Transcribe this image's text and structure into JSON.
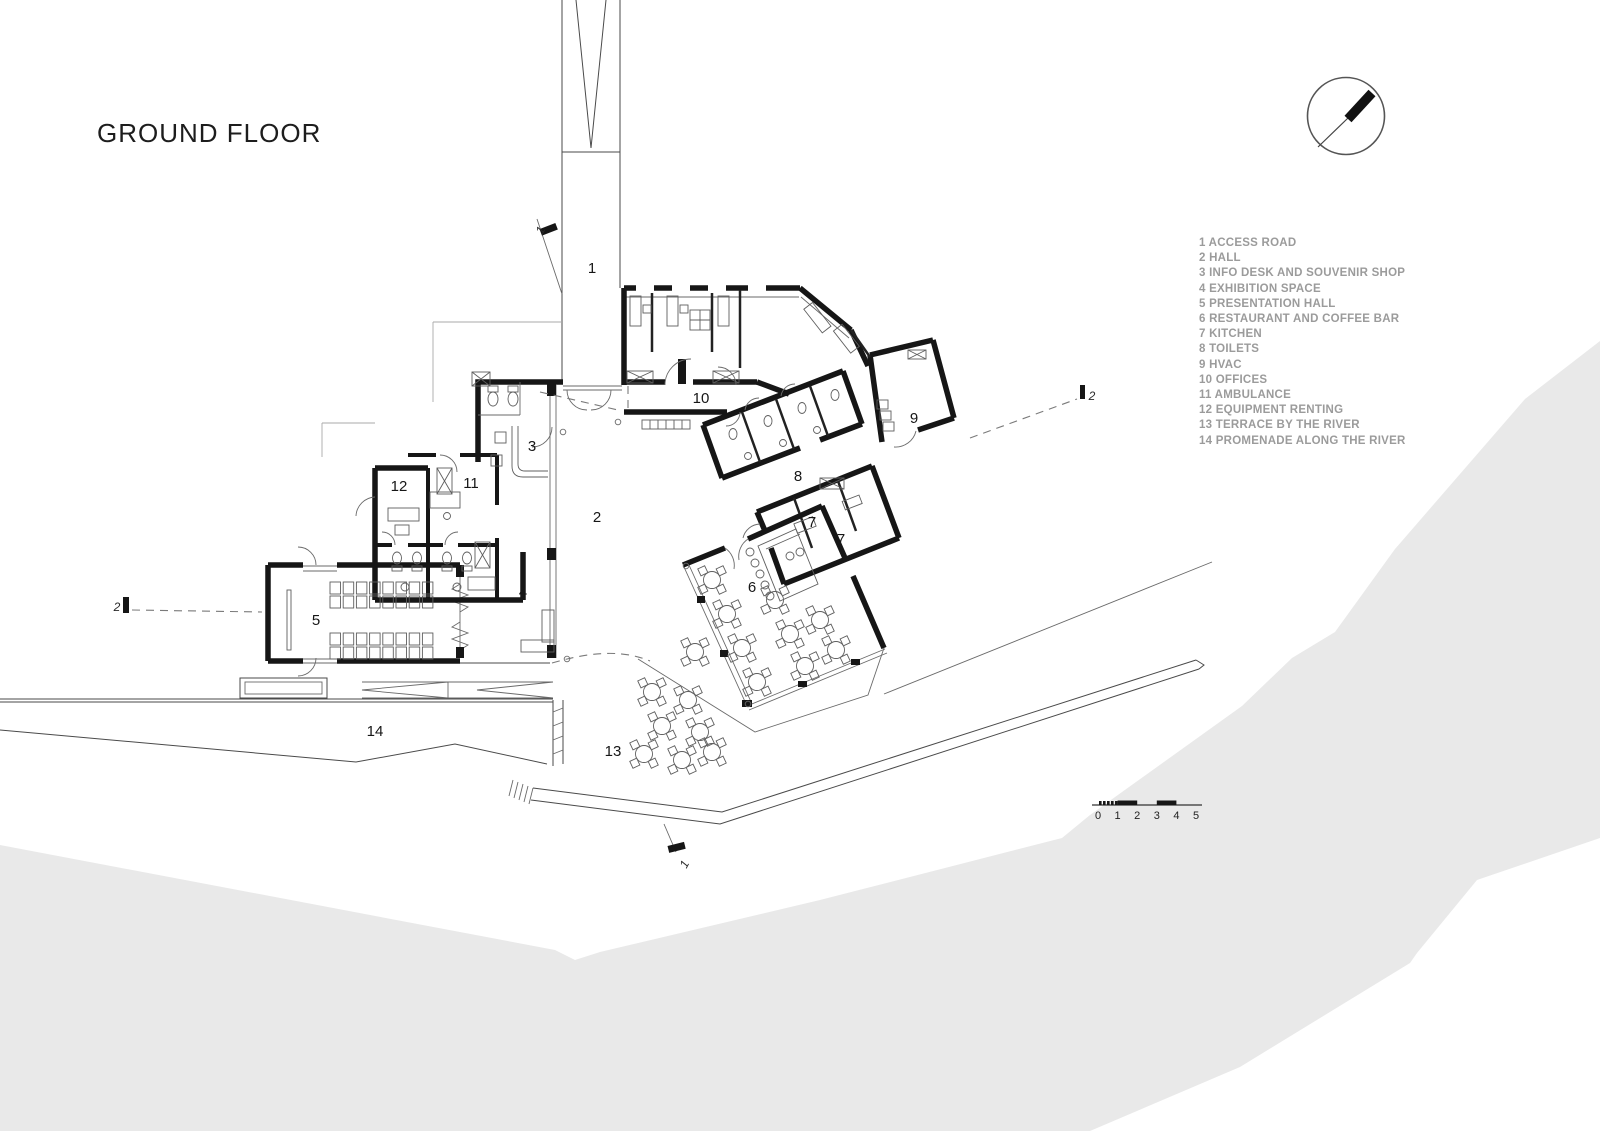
{
  "title": "GROUND FLOOR",
  "legend": {
    "items": [
      "1 ACCESS ROAD",
      "2 HALL",
      "3 INFO DESK AND SOUVENIR SHOP",
      "4 EXHIBITION SPACE",
      "5 PRESENTATION HALL",
      "6 RESTAURANT AND COFFEE BAR",
      "7 KITCHEN",
      "8 TOILETS",
      "9 HVAC",
      "10 OFFICES",
      "11 AMBULANCE",
      "12 EQUIPMENT RENTING",
      "13 TERRACE BY THE RIVER",
      "14 PROMENADE ALONG THE RIVER"
    ]
  },
  "plan": {
    "room_labels": [
      {
        "n": "1",
        "x": 592,
        "y": 273
      },
      {
        "n": "2",
        "x": 597,
        "y": 522
      },
      {
        "n": "3",
        "x": 532,
        "y": 451
      },
      {
        "n": "4",
        "x": 523,
        "y": 597
      },
      {
        "n": "5",
        "x": 316,
        "y": 625
      },
      {
        "n": "6",
        "x": 752,
        "y": 592
      },
      {
        "n": "7",
        "x": 812,
        "y": 527
      },
      {
        "n": "7",
        "x": 841,
        "y": 544
      },
      {
        "n": "8",
        "x": 798,
        "y": 481
      },
      {
        "n": "9",
        "x": 914,
        "y": 423
      },
      {
        "n": "10",
        "x": 701,
        "y": 403
      },
      {
        "n": "11",
        "x": 471,
        "y": 488
      },
      {
        "n": "12",
        "x": 399,
        "y": 491
      },
      {
        "n": "13",
        "x": 613,
        "y": 756
      },
      {
        "n": "14",
        "x": 375,
        "y": 736
      }
    ],
    "section_labels": [
      {
        "n": "1",
        "x": 544,
        "y": 232,
        "rot": -62
      },
      {
        "n": "1",
        "x": 688,
        "y": 866,
        "rot": -62
      },
      {
        "n": "2",
        "x": 117,
        "y": 611,
        "rot": 0
      },
      {
        "n": "2",
        "x": 1092,
        "y": 400,
        "rot": 0
      }
    ],
    "furniture": {
      "restaurant_tables": [
        [
          712,
          580
        ],
        [
          727,
          614
        ],
        [
          742,
          648
        ],
        [
          757,
          682
        ],
        [
          775,
          600
        ],
        [
          790,
          634
        ],
        [
          805,
          666
        ],
        [
          820,
          620
        ],
        [
          836,
          650
        ]
      ],
      "terrace_tables": [
        [
          695,
          652
        ],
        [
          652,
          692
        ],
        [
          688,
          700
        ],
        [
          662,
          726
        ],
        [
          700,
          732
        ],
        [
          644,
          754
        ],
        [
          682,
          760
        ],
        [
          712,
          752
        ]
      ],
      "bar_stools": [
        [
          750,
          552
        ],
        [
          755,
          563
        ],
        [
          760,
          574
        ],
        [
          765,
          585
        ],
        [
          770,
          596
        ]
      ],
      "presentation_seats": {
        "x0": 330,
        "pitch": 13.2,
        "cols": 8,
        "rows": [
          582,
          596,
          633,
          647
        ],
        "w": 10.5,
        "h": 12
      }
    }
  },
  "scale_bar": {
    "numbers": [
      "0",
      "1",
      "2",
      "3",
      "4",
      "5"
    ],
    "x0": 1098,
    "step": 19.6,
    "y": 819
  },
  "icons": {
    "compass": "north-arrow"
  },
  "colors": {
    "wall": "#161616",
    "thin_line": "#4a4a4a",
    "faint_line": "#a8a8a8",
    "river": "#e9e9e9",
    "legend_text": "#9b9b9b",
    "label_text": "#161616"
  }
}
